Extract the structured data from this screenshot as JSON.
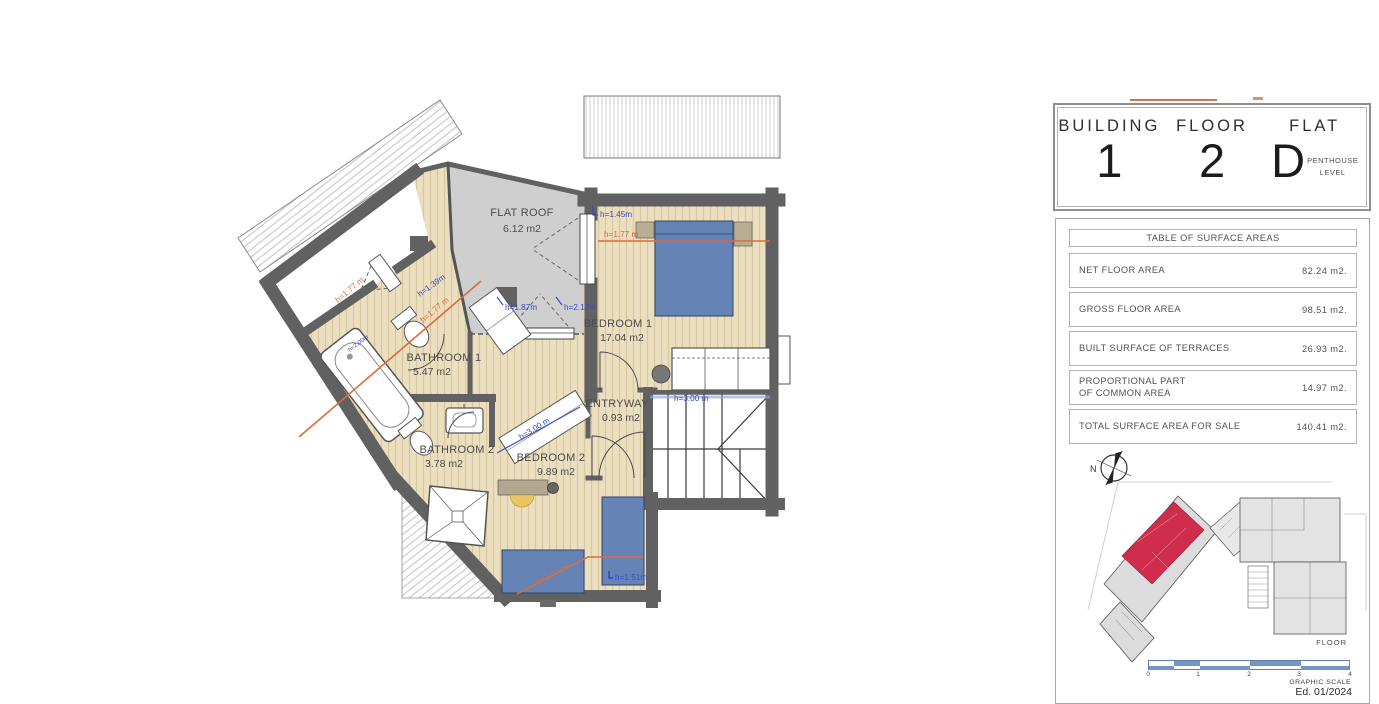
{
  "plan": {
    "rooms": [
      {
        "name": "FLAT ROOF",
        "area": "6.12 m2"
      },
      {
        "name": "BEDROOM 1",
        "area": "17.04 m2"
      },
      {
        "name": "BATHROOM 1",
        "area": "5.47 m2"
      },
      {
        "name": "BATHROOM 2",
        "area": "3.78 m2"
      },
      {
        "name": "BEDROOM 2",
        "area": "9.89 m2"
      },
      {
        "name": "ENTRYWAY",
        "area": "0.93 m2"
      }
    ],
    "heights": {
      "h145": "h=1.45m",
      "h177a": "h=1.77 m",
      "h187": "h=1.87m",
      "h217": "h=2.17m",
      "h139": "h=1.39m",
      "h177b": "h=1.77 m",
      "h177c": "h=1.77 m",
      "h200": "h=2.00m",
      "h300a": "h=3.00 m",
      "h300b": "h=3.00 m",
      "h177d": "h=1.77 m",
      "h151": "h=1.51m"
    }
  },
  "panel": {
    "header": {
      "columns": [
        {
          "label": "BUILDING",
          "value": "1"
        },
        {
          "label": "FLOOR",
          "value": "2"
        },
        {
          "label": "FLAT",
          "value": "D"
        }
      ],
      "flat_note_line1": "PENTHOUSE",
      "flat_note_line2": "LEVEL"
    },
    "table": {
      "title": "TABLE OF SURFACE AREAS",
      "rows": [
        {
          "label": "NET FLOOR AREA",
          "value": "82.24 m2."
        },
        {
          "label": "GROSS FLOOR AREA",
          "value": "98.51 m2."
        },
        {
          "label": "BUILT SURFACE OF TERRACES",
          "value": "26.93 m2."
        },
        {
          "label": "PROPORTIONAL PART",
          "label2": "OF COMMON AREA",
          "value": "14.97 m2."
        },
        {
          "label": "TOTAL SURFACE AREA FOR SALE",
          "value": "140.41 m2."
        }
      ]
    },
    "site_plan": {
      "north_label": "N",
      "floor_caption": "FLOOR"
    },
    "scale": {
      "ticks": [
        "0",
        "1",
        "2",
        "3",
        "4"
      ],
      "caption": "GRAPHIC SCALE",
      "edition": "Ed. 01/2024"
    }
  },
  "colors": {
    "wall": "#616161",
    "floor_tan": "#ecdfc0",
    "flat_roof_gray": "#cfcfcf",
    "bed_blue": "#6584b5",
    "annotation_blue": "#3a49c2",
    "annotation_orange": "#df6a3c",
    "flat_highlight_red": "#d02d4d",
    "scale_blue": "#7596c2"
  }
}
